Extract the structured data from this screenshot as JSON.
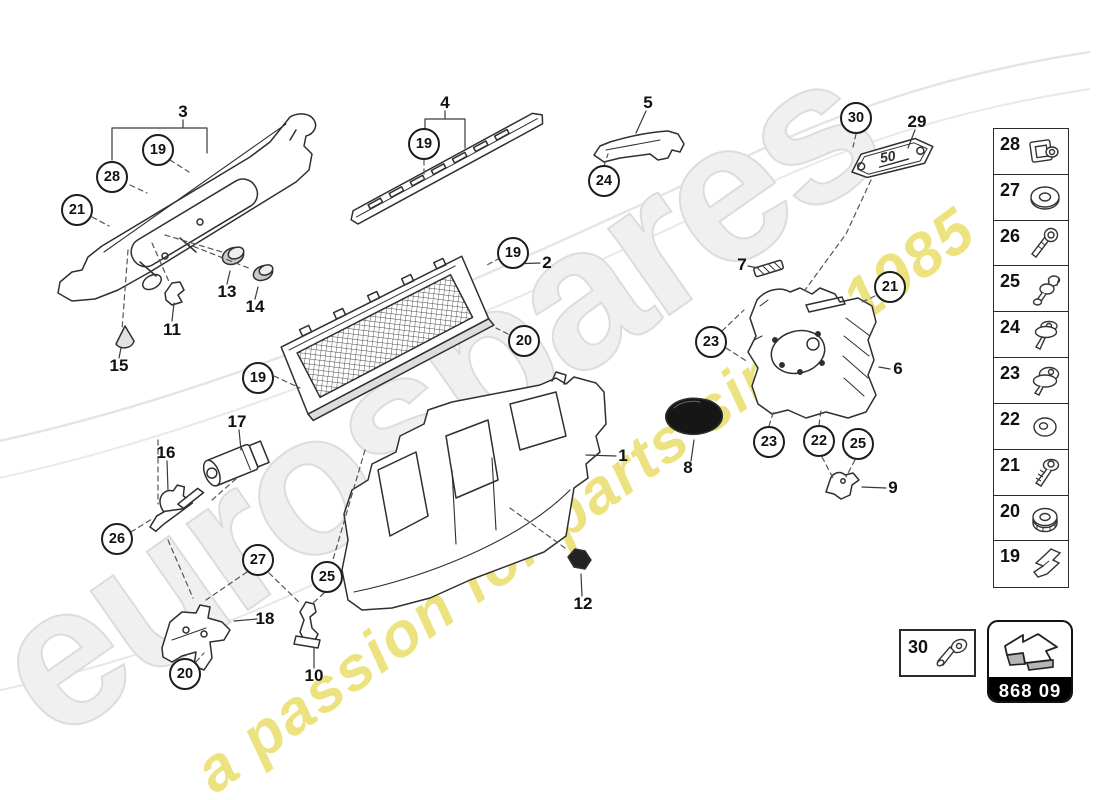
{
  "watermark": {
    "brand": "eurospares",
    "tagline": "a passion for parts since 1985",
    "brand_color": "#f0f0f0",
    "tagline_color": "#e7db5c"
  },
  "diagram_code": {
    "label": "868 09"
  },
  "plate_badge": {
    "text": "50"
  },
  "callouts": [
    {
      "n": "19"
    },
    {
      "n": "28"
    },
    {
      "n": "21"
    },
    {
      "n": "19"
    },
    {
      "n": "24"
    },
    {
      "n": "30"
    },
    {
      "n": "19"
    },
    {
      "n": "20"
    },
    {
      "n": "19"
    },
    {
      "n": "21"
    },
    {
      "n": "23"
    },
    {
      "n": "23"
    },
    {
      "n": "22"
    },
    {
      "n": "25"
    },
    {
      "n": "26"
    },
    {
      "n": "27"
    },
    {
      "n": "25"
    },
    {
      "n": "20"
    }
  ],
  "labels": [
    {
      "n": "3"
    },
    {
      "n": "4"
    },
    {
      "n": "5"
    },
    {
      "n": "29"
    },
    {
      "n": "2"
    },
    {
      "n": "7"
    },
    {
      "n": "6"
    },
    {
      "n": "8"
    },
    {
      "n": "9"
    },
    {
      "n": "1"
    },
    {
      "n": "13"
    },
    {
      "n": "14"
    },
    {
      "n": "11"
    },
    {
      "n": "15"
    },
    {
      "n": "17"
    },
    {
      "n": "16"
    },
    {
      "n": "18"
    },
    {
      "n": "10"
    },
    {
      "n": "12"
    }
  ],
  "sidebar": {
    "rows": [
      {
        "n": "28",
        "icon": "captive-nut-clip-icon"
      },
      {
        "n": "27",
        "icon": "large-washer-icon"
      },
      {
        "n": "26",
        "icon": "torx-bolt-icon"
      },
      {
        "n": "25",
        "icon": "ball-stud-icon"
      },
      {
        "n": "24",
        "icon": "push-rivet-icon"
      },
      {
        "n": "23",
        "icon": "washer-screw-icon"
      },
      {
        "n": "22",
        "icon": "washer-icon"
      },
      {
        "n": "21",
        "icon": "coarse-thread-screw-icon"
      },
      {
        "n": "20",
        "icon": "flange-nut-icon"
      },
      {
        "n": "19",
        "icon": "spring-clip-icon"
      }
    ]
  },
  "inset": {
    "n": "30",
    "icon": "countersunk-screw-icon"
  }
}
